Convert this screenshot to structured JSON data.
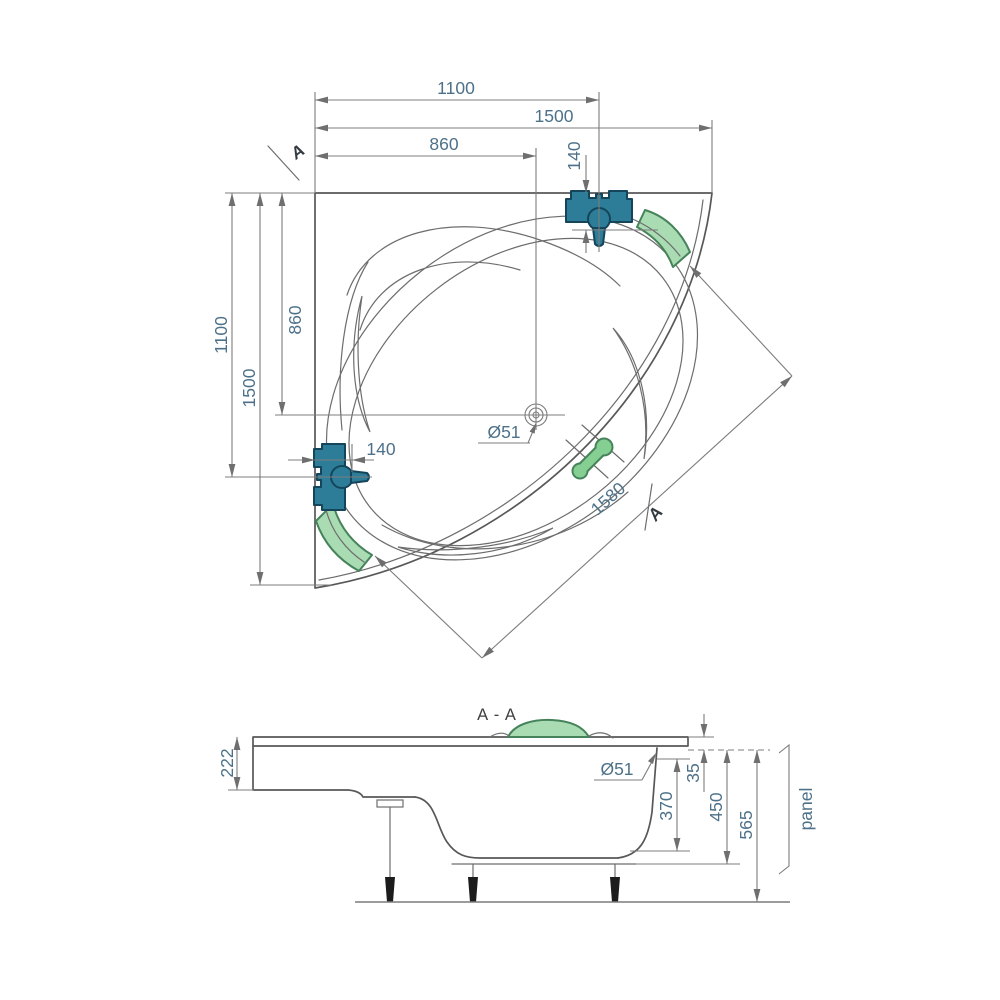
{
  "top_view": {
    "marker_upper": "A",
    "marker_lower": "A",
    "dim_1100_top": "1100",
    "dim_1500_top": "1500",
    "dim_860_top": "860",
    "dim_140_top": "140",
    "dim_1100_left": "1100",
    "dim_1500_left": "1500",
    "dim_860_left": "860",
    "dim_140_left": "140",
    "drain_label": "Ø51",
    "diagonal_label": "1580"
  },
  "section_view": {
    "title": "A - A",
    "dim_222": "222",
    "drain_label": "Ø51",
    "dim_35": "35",
    "dim_370": "370",
    "dim_450": "450",
    "dim_565": "565",
    "panel_label": "panel"
  },
  "colors": {
    "dimension_text": "#4d7189",
    "drawing_line": "#585858",
    "dimension_line": "#7c7c7c",
    "faucet_fill": "#2d7d98",
    "faucet_stroke": "#14455a",
    "headrest_fill": "#a9dcb2",
    "headrest_stroke": "#46835a",
    "handle_fill": "#85cf92",
    "section_title": "#3f3f3f"
  }
}
